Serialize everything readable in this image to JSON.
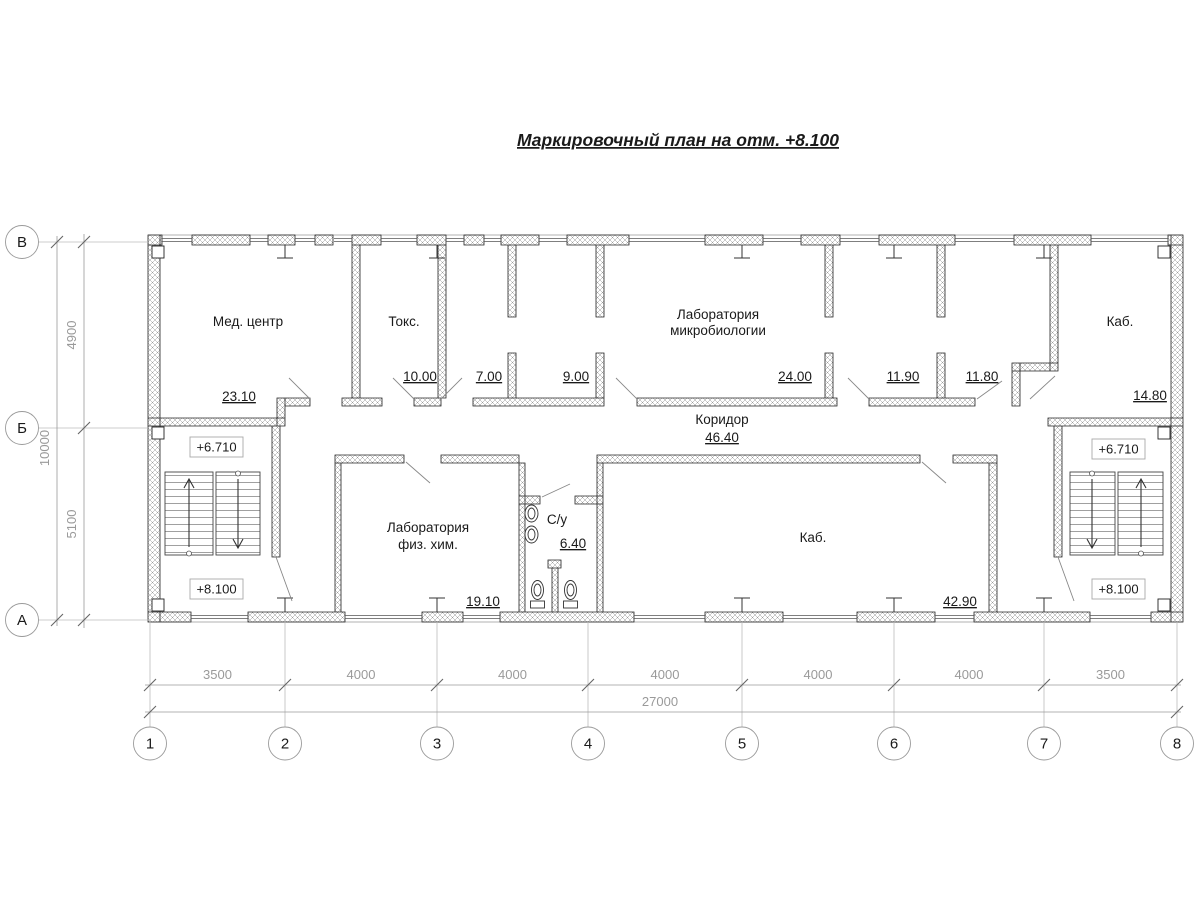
{
  "title": "Маркировочный план на отм. +8.100",
  "rooms": {
    "med_center": {
      "name": "Мед. центр",
      "area": "23.10"
    },
    "toks": {
      "name": "Токс.",
      "area": "10.00"
    },
    "room_7": {
      "area": "7.00"
    },
    "room_9": {
      "area": "9.00"
    },
    "micro_lab": {
      "name_line1": "Лаборатория",
      "name_line2": "микробиологии",
      "area": "24.00"
    },
    "room_11_90": {
      "area": "11.90"
    },
    "room_11_80": {
      "area": "11.80"
    },
    "kab_top": {
      "name": "Каб.",
      "area": "14.80"
    },
    "corridor": {
      "name": "Коридор",
      "area": "46.40"
    },
    "fiz_him_lab": {
      "name_line1": "Лаборатория",
      "name_line2": "физ. хим.",
      "area": "19.10"
    },
    "su": {
      "name": "С/у",
      "area": "6.40"
    },
    "kab_bottom": {
      "name": "Каб.",
      "area": "42.90"
    }
  },
  "elevations": {
    "upper_landing": "+6.710",
    "floor": "+8.100"
  },
  "axes": {
    "horizontal": [
      "1",
      "2",
      "3",
      "4",
      "5",
      "6",
      "7",
      "8"
    ],
    "vertical_top_to_bottom": [
      "В",
      "Б",
      "А"
    ]
  },
  "dimensions": {
    "bottom_segments": [
      "3500",
      "4000",
      "4000",
      "4000",
      "4000",
      "4000",
      "3500"
    ],
    "bottom_total": "27000",
    "left_segments_top_to_bottom": [
      "4900",
      "5100"
    ],
    "left_total": "10000"
  },
  "colors": {
    "line": "#222222",
    "dim": "#9a9a9a",
    "background": "#ffffff"
  }
}
